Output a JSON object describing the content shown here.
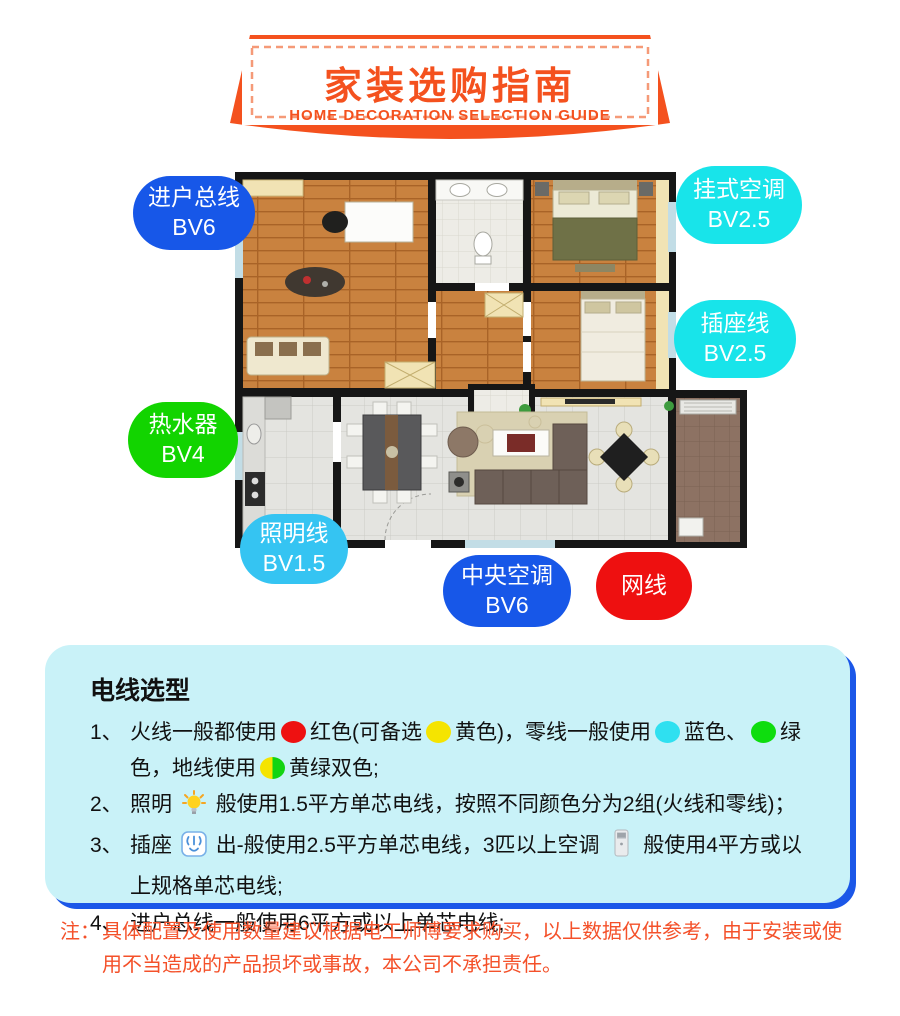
{
  "header": {
    "title": "家装选购指南",
    "subtitle": "HOME DECORATION SELECTION GUIDE",
    "accent_color": "#f4511e"
  },
  "floorplan": {
    "labels": [
      {
        "name": "entry-main-wire",
        "lines": [
          "进户总线",
          "BV6"
        ],
        "color": "#1757e8"
      },
      {
        "name": "wall-air-conditioner",
        "lines": [
          "挂式空调",
          "BV2.5"
        ],
        "color": "#18e4ea"
      },
      {
        "name": "socket-wire",
        "lines": [
          "插座线",
          "BV2.5"
        ],
        "color": "#18e4ea"
      },
      {
        "name": "water-heater",
        "lines": [
          "热水器",
          "BV4"
        ],
        "color": "#12d400"
      },
      {
        "name": "lighting-wire",
        "lines": [
          "照明线",
          "BV1.5"
        ],
        "color": "#35c4f2"
      },
      {
        "name": "central-air-conditioner",
        "lines": [
          "中央空调",
          "BV6"
        ],
        "color": "#1757e8"
      },
      {
        "name": "network-cable",
        "lines": [
          "网线"
        ],
        "color": "#ee1010"
      }
    ]
  },
  "wire_section": {
    "title": "电线选型",
    "items": [
      {
        "num": "1、",
        "segments": [
          {
            "text": "火线一般都使用"
          },
          {
            "dot": "#ee1111"
          },
          {
            "text": "红色(可备选"
          },
          {
            "dot": "#f5e400"
          },
          {
            "text": "黄色)，零线一般使用"
          },
          {
            "dot": "#2fe0f0"
          },
          {
            "text": "蓝色、"
          },
          {
            "dot": "#0edd0e"
          },
          {
            "text": "绿色，地线使用"
          },
          {
            "dot": "half"
          },
          {
            "text": "黄绿双色;"
          }
        ]
      },
      {
        "num": "2、",
        "segments": [
          {
            "text": "照明"
          },
          {
            "icon": "bulb"
          },
          {
            "text": "般使用1.5平方单芯电线，按照不同颜色分为2组(火线和零线)；"
          }
        ]
      },
      {
        "num": "3、",
        "segments": [
          {
            "text": "插座"
          },
          {
            "icon": "socket"
          },
          {
            "text": "出-般使用2.5平方单芯电线，3匹以上空调"
          },
          {
            "icon": "ac"
          },
          {
            "text": "般使用4平方或以上规格单芯电线;"
          }
        ]
      },
      {
        "num": "4、",
        "segments": [
          {
            "text": "进户总线一般使用6平方或以上单芯电线;"
          }
        ]
      }
    ]
  },
  "note": {
    "prefix": "注：",
    "text": "具体配置及使用数量建议根据电工师傅要求购买，以上数据仅供参考，由于安装或使用不当造成的产品损坏或事故，本公司不承担责任。"
  }
}
